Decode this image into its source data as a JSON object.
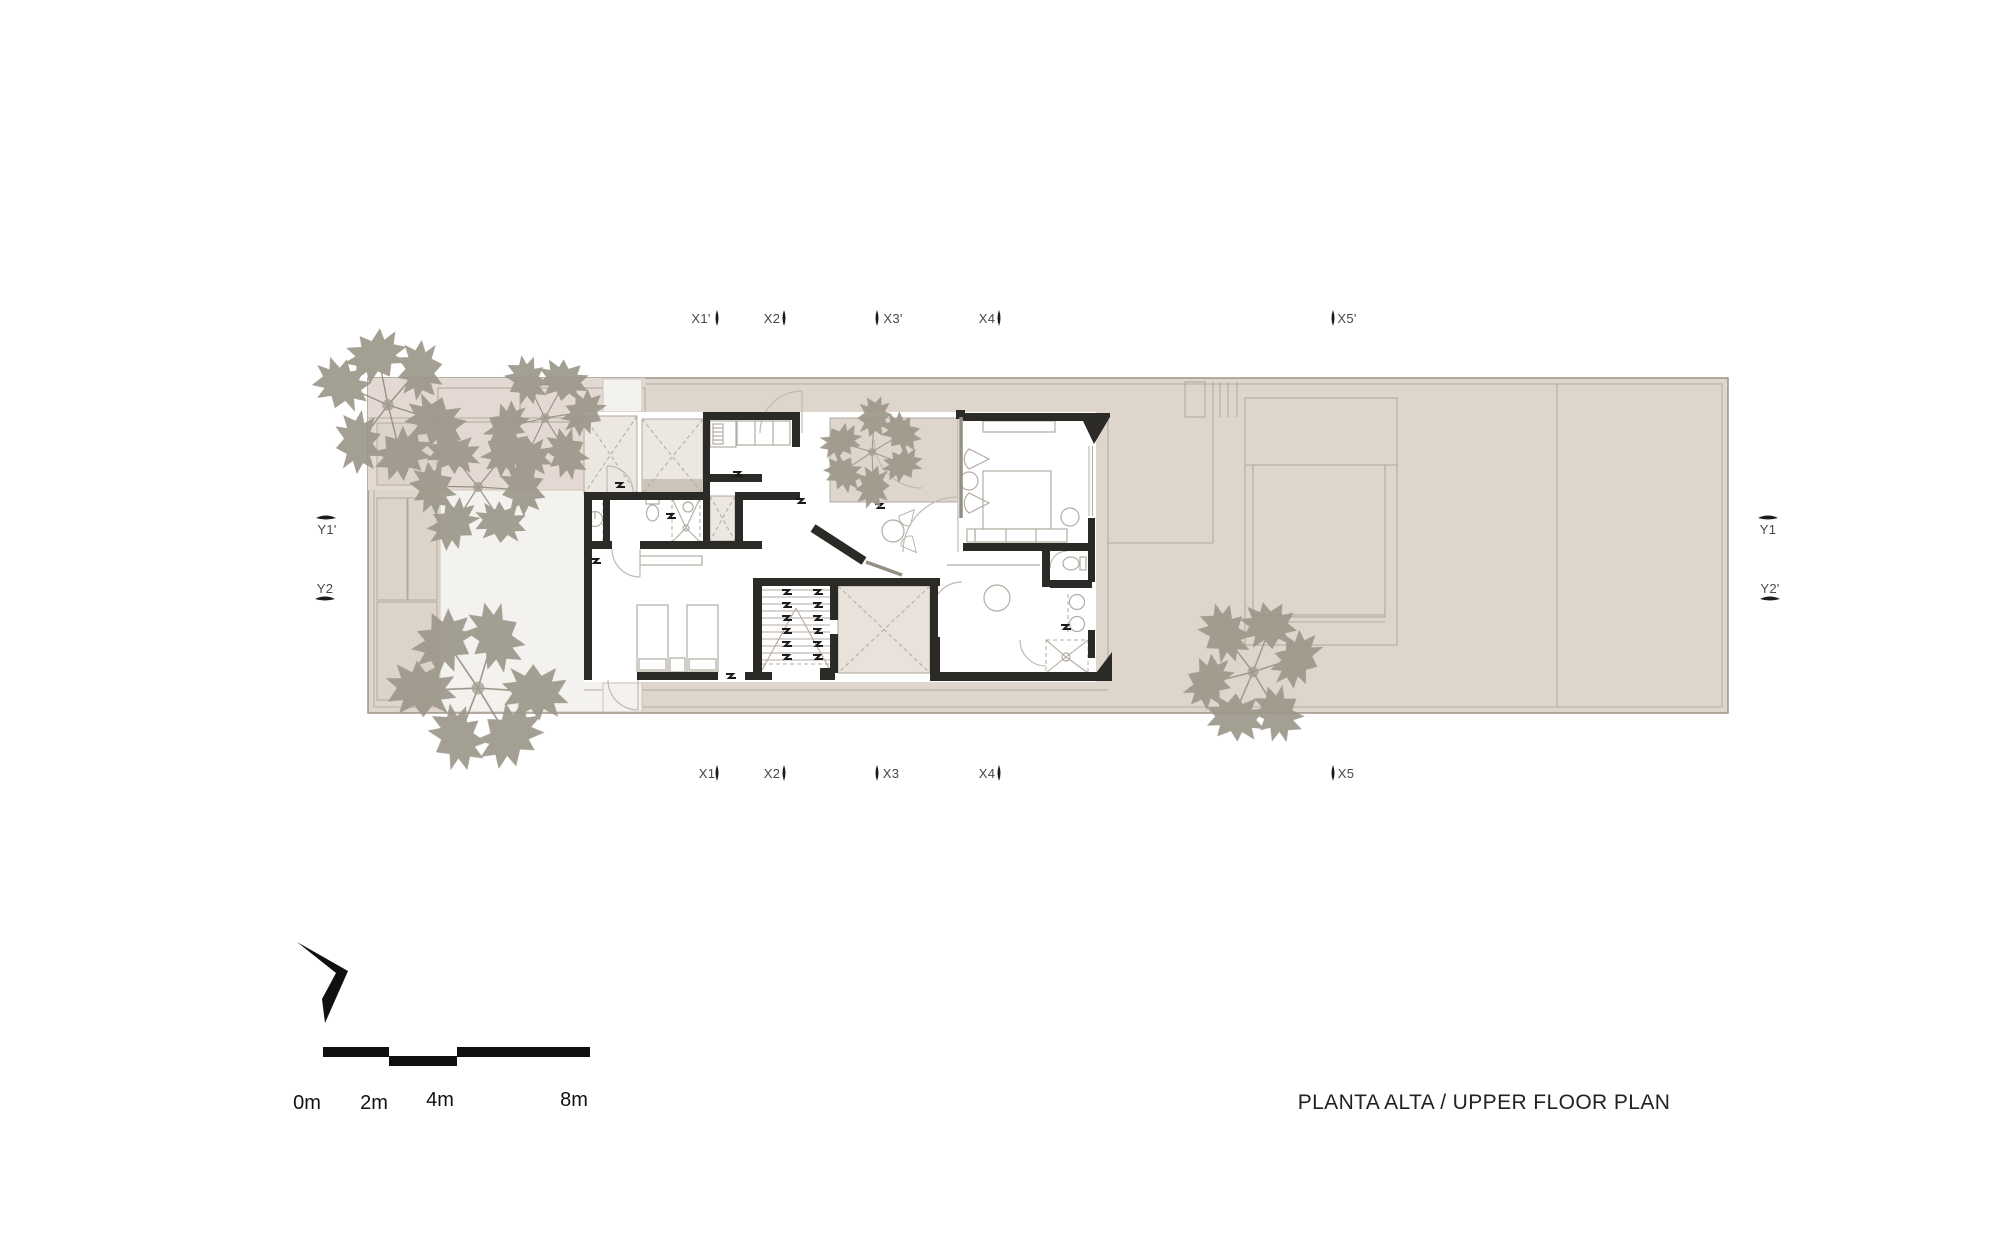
{
  "title": "PLANTA ALTA / UPPER FLOOR PLAN",
  "axes": {
    "top": [
      "X1'",
      "X2",
      "X3'",
      "X4",
      "X5'"
    ],
    "bottom": [
      "X1",
      "X2",
      "X3",
      "X4",
      "X5"
    ],
    "left": [
      "Y1'",
      "Y2"
    ],
    "right": [
      "Y1",
      "Y2'"
    ]
  },
  "scale_bar": {
    "labels": [
      "0m",
      "2m",
      "4m",
      "8m"
    ]
  },
  "icons": {
    "north_arrow": "north-arrow-icon",
    "axis_tick": "axis-tick-icon",
    "tree": "tree-icon",
    "level_mark": "level-mark-icon"
  },
  "colors": {
    "site": "#ded6cd",
    "siteline": "#968d81",
    "tint": "#e3d9d2",
    "patio": "#f4f2ef",
    "terrace": "#ded6cd",
    "closet": "#ece7e1",
    "band": "#cbc4b8",
    "voidc": "#e8e2db",
    "wall": "#2c2a27",
    "line": "#b3aa9f",
    "furn": "#b2ada3",
    "arc": "#bfbab1",
    "tree": "#9c978a",
    "branch": "#8f8b7e",
    "text": "#474747",
    "title": "#222222"
  }
}
